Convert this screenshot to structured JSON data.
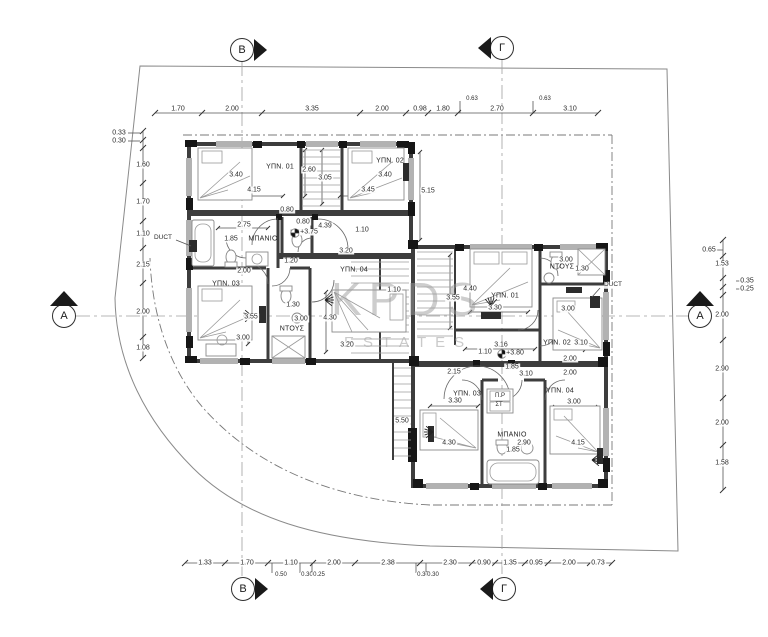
{
  "watermark": {
    "line1": "KPDS",
    "line2": "ESTATES"
  },
  "markers": {
    "top_b": "B",
    "top_gamma": "Γ",
    "bottom_b": "B",
    "bottom_gamma": "Γ",
    "left_a": "A",
    "right_a": "A"
  },
  "labels": {
    "duct_left": "DUCT",
    "duct_right": "DUCT"
  },
  "chains": {
    "top": [
      {
        "t": "1.70",
        "x": 178,
        "y": 109
      },
      {
        "t": "2.00",
        "x": 232,
        "y": 109
      },
      {
        "t": "3.35",
        "x": 312,
        "y": 109
      },
      {
        "t": "2.00",
        "x": 382,
        "y": 109
      },
      {
        "t": "0.98",
        "x": 420,
        "y": 109
      },
      {
        "t": "1.80",
        "x": 443,
        "y": 109
      },
      {
        "t": "2.70",
        "x": 497,
        "y": 109
      },
      {
        "t": "3.10",
        "x": 570,
        "y": 109
      }
    ],
    "top_sub": [
      {
        "t": "0.63",
        "x": 472,
        "y": 99
      },
      {
        "t": "0.63",
        "x": 545,
        "y": 99
      }
    ],
    "left": [
      {
        "t": "0.33",
        "x": 119,
        "y": 133
      },
      {
        "t": "0.30",
        "x": 119,
        "y": 141
      },
      {
        "t": "1.60",
        "x": 143,
        "y": 165
      },
      {
        "t": "1.70",
        "x": 143,
        "y": 202
      },
      {
        "t": "1.10",
        "x": 143,
        "y": 234
      },
      {
        "t": "2.15",
        "x": 143,
        "y": 265
      },
      {
        "t": "2.00",
        "x": 143,
        "y": 312
      },
      {
        "t": "1.08",
        "x": 143,
        "y": 348
      }
    ],
    "right": [
      {
        "t": "0.65",
        "x": 709,
        "y": 250
      },
      {
        "t": "1.53",
        "x": 722,
        "y": 264
      },
      {
        "t": "0.35",
        "x": 747,
        "y": 281
      },
      {
        "t": "0.25",
        "x": 747,
        "y": 289
      },
      {
        "t": "2.00",
        "x": 722,
        "y": 315
      },
      {
        "t": "2.90",
        "x": 722,
        "y": 369
      },
      {
        "t": "2.00",
        "x": 722,
        "y": 423
      },
      {
        "t": "1.58",
        "x": 722,
        "y": 463
      }
    ],
    "bottom": [
      {
        "t": "1.33",
        "x": 205,
        "y": 563
      },
      {
        "t": "1.70",
        "x": 247,
        "y": 563
      },
      {
        "t": "1.10",
        "x": 291,
        "y": 563
      },
      {
        "t": "2.00",
        "x": 334,
        "y": 563
      },
      {
        "t": "2.38",
        "x": 388,
        "y": 563
      },
      {
        "t": "2.30",
        "x": 450,
        "y": 563
      },
      {
        "t": "0.90",
        "x": 484,
        "y": 563
      },
      {
        "t": "1.35",
        "x": 510,
        "y": 563
      },
      {
        "t": "0.95",
        "x": 536,
        "y": 563
      },
      {
        "t": "2.00",
        "x": 569,
        "y": 563
      },
      {
        "t": "0.73",
        "x": 598,
        "y": 563
      }
    ],
    "bottom_sub": [
      {
        "t": "0.50",
        "x": 281,
        "y": 575
      },
      {
        "t": "0.30",
        "x": 307,
        "y": 575
      },
      {
        "t": "0.25",
        "x": 319,
        "y": 575
      },
      {
        "t": "0.30",
        "x": 423,
        "y": 575
      },
      {
        "t": "0.30",
        "x": 433,
        "y": 575
      }
    ]
  },
  "unit1": {
    "rooms": [
      {
        "t": "ΥΠΝ. 01",
        "x": 280,
        "y": 167
      },
      {
        "t": "ΥΠΝ. 02",
        "x": 390,
        "y": 161
      },
      {
        "t": "ΥΠΝ. 03",
        "x": 226,
        "y": 284
      },
      {
        "t": "ΥΠΝ. 04",
        "x": 354,
        "y": 270
      },
      {
        "t": "ΜΠΑΝΙΟ",
        "x": 263,
        "y": 239
      },
      {
        "t": "ΝΤΟΥΣ",
        "x": 292,
        "y": 329
      }
    ],
    "dims": [
      {
        "t": "3.40",
        "x": 236,
        "y": 175
      },
      {
        "t": "4.15",
        "x": 254,
        "y": 190
      },
      {
        "t": "2.60",
        "x": 309,
        "y": 170
      },
      {
        "t": "3.05",
        "x": 325,
        "y": 178
      },
      {
        "t": "3.40",
        "x": 385,
        "y": 175
      },
      {
        "t": "3.45",
        "x": 368,
        "y": 190
      },
      {
        "t": "5.15",
        "x": 428,
        "y": 191
      },
      {
        "t": "2.75",
        "x": 244,
        "y": 225
      },
      {
        "t": "0.80",
        "x": 287,
        "y": 210
      },
      {
        "t": "0.80",
        "x": 303,
        "y": 222
      },
      {
        "t": "4.39",
        "x": 325,
        "y": 226
      },
      {
        "t": "+3.75",
        "x": 309,
        "y": 232
      },
      {
        "t": "1.10",
        "x": 362,
        "y": 230
      },
      {
        "t": "1.85",
        "x": 231,
        "y": 239
      },
      {
        "t": "1.20",
        "x": 291,
        "y": 261
      },
      {
        "t": "3.20",
        "x": 346,
        "y": 251
      },
      {
        "t": "2.00",
        "x": 244,
        "y": 271
      },
      {
        "t": "1.10",
        "x": 394,
        "y": 290
      },
      {
        "t": "3.55",
        "x": 251,
        "y": 317
      },
      {
        "t": "1.30",
        "x": 293,
        "y": 305
      },
      {
        "t": "3.00",
        "x": 301,
        "y": 319
      },
      {
        "t": "4.30",
        "x": 330,
        "y": 318
      },
      {
        "t": "3.00",
        "x": 243,
        "y": 338
      },
      {
        "t": "3.20",
        "x": 347,
        "y": 345
      }
    ]
  },
  "unit2": {
    "rooms": [
      {
        "t": "ΥΠΝ. 01",
        "x": 505,
        "y": 296
      },
      {
        "t": "ΥΠΝ. 02",
        "x": 557,
        "y": 343
      },
      {
        "t": "ΥΠΝ. 03",
        "x": 467,
        "y": 394
      },
      {
        "t": "ΥΠΝ. 04",
        "x": 560,
        "y": 391
      },
      {
        "t": "ΜΠΑΝΙΟ",
        "x": 512,
        "y": 435
      },
      {
        "t": "ΝΤΟΥΣ",
        "x": 562,
        "y": 267
      }
    ],
    "dims": [
      {
        "t": "4.40",
        "x": 470,
        "y": 289
      },
      {
        "t": "3.55",
        "x": 453,
        "y": 298
      },
      {
        "t": "3.30",
        "x": 495,
        "y": 308
      },
      {
        "t": "3.00",
        "x": 566,
        "y": 260
      },
      {
        "t": "1.30",
        "x": 582,
        "y": 269
      },
      {
        "t": "3.00",
        "x": 568,
        "y": 309
      },
      {
        "t": "3.10",
        "x": 581,
        "y": 343
      },
      {
        "t": "3.16",
        "x": 501,
        "y": 345
      },
      {
        "t": "1.10",
        "x": 485,
        "y": 352
      },
      {
        "t": "+3.80",
        "x": 515,
        "y": 353
      },
      {
        "t": "2.00",
        "x": 570,
        "y": 359
      },
      {
        "t": "2.15",
        "x": 454,
        "y": 372
      },
      {
        "t": "1.85",
        "x": 512,
        "y": 367
      },
      {
        "t": "3.10",
        "x": 526,
        "y": 374
      },
      {
        "t": "2.00",
        "x": 570,
        "y": 373
      },
      {
        "t": "3.30",
        "x": 455,
        "y": 401
      },
      {
        "t": "3.00",
        "x": 574,
        "y": 402
      },
      {
        "t": "5.50",
        "x": 402,
        "y": 421
      },
      {
        "t": "4.30",
        "x": 449,
        "y": 443
      },
      {
        "t": "2.90",
        "x": 524,
        "y": 443
      },
      {
        "t": "1.85",
        "x": 513,
        "y": 450
      },
      {
        "t": "4.15",
        "x": 578,
        "y": 443
      }
    ],
    "appliances": [
      {
        "t": "Π.Ρ",
        "x": 500,
        "y": 396
      },
      {
        "t": "ΣΤ",
        "x": 499,
        "y": 405
      }
    ]
  }
}
